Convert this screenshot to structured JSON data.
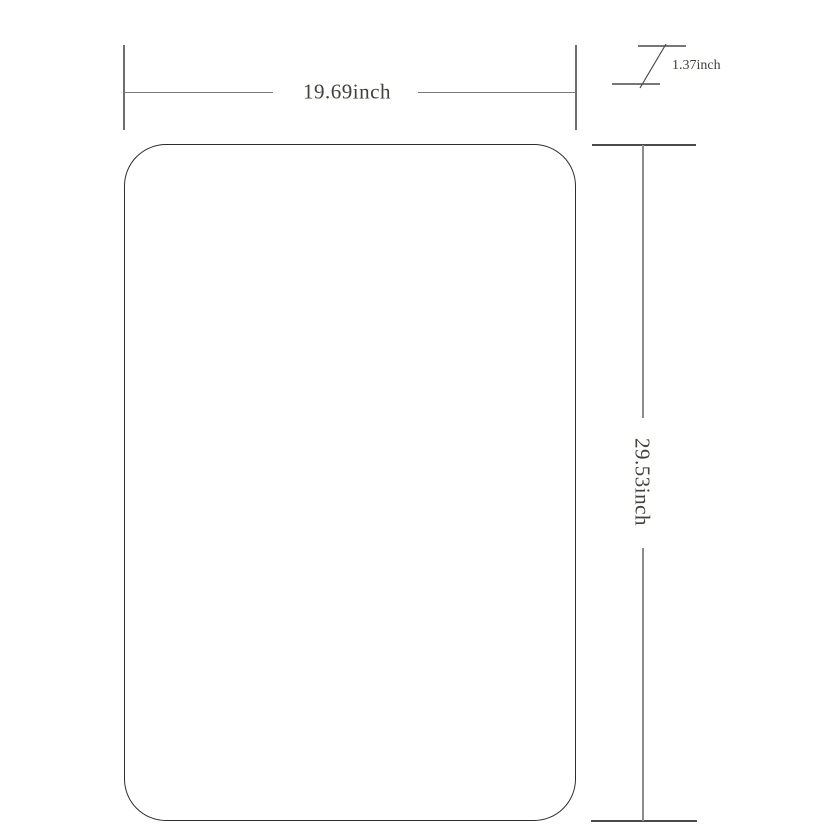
{
  "colors": {
    "background": "#ffffff",
    "outline": "#2e2e2e",
    "dim-line": "#7a7a7a",
    "dim-tick": "#6e6e6e",
    "dim-vline": "#8c8c8c",
    "dim-dark": "#4a4a4a",
    "label-text": "#44403a"
  },
  "drawing": {
    "unit": "inch",
    "width_dimension": {
      "label": "19.69inch",
      "value": "19.69"
    },
    "height_dimension": {
      "label": "29.53inch",
      "value": "29.53"
    },
    "thickness_dimension": {
      "label": "1.37inch",
      "value": "1.37"
    }
  }
}
